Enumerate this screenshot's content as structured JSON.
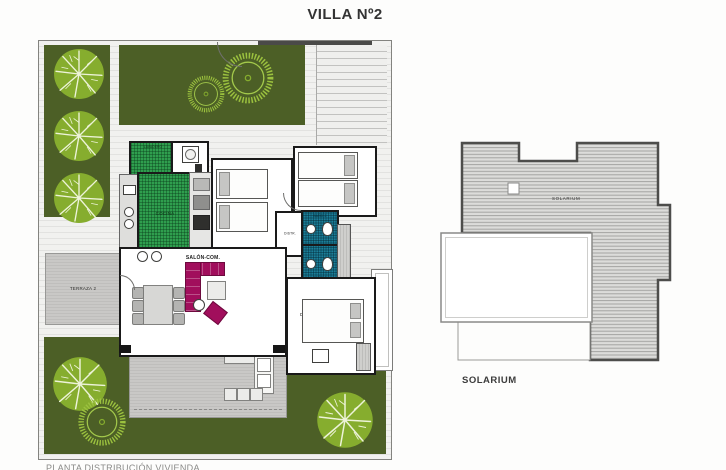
{
  "title": "VILLA Nº2",
  "plan": {
    "rooms": {
      "lavadero": "LAVADERO",
      "cocina": "COCINA",
      "dorm2": "DORM 2",
      "dorm3": "DORM 3",
      "distr": "DISTR.",
      "bano2": "BAÑO 2",
      "bano1": "BAÑO 1",
      "salon": "SALÓN-COM.",
      "dorm1": "DORM 1",
      "terraza1": "TERRAZA 1",
      "terraza2": "TERRAZA 2"
    }
  },
  "roof": {
    "label": "SOLARIUM",
    "caption": "SOLARIUM"
  },
  "footer_caption": "PLANTA DISTRIBUCIÓN VIVIENDA",
  "colors": {
    "lawn": "#4c5f26",
    "tree": "#8db339",
    "kitchen_tiles": "#2f9e4e",
    "bath_tiles": "#1b7f99",
    "sofa_accent": "#a10e5c",
    "terrace": "#c7c6c4",
    "roof_hatch": "#dbdbd9"
  }
}
